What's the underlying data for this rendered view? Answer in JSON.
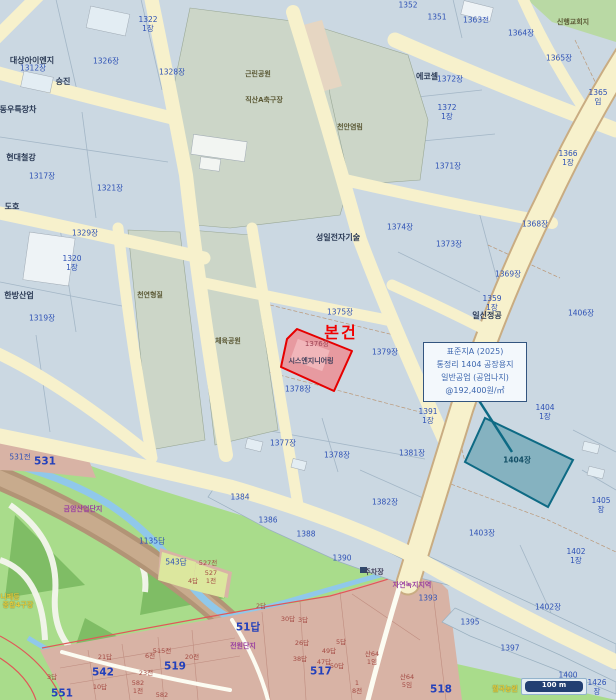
{
  "subject": {
    "marker": "본건",
    "parcel_no": "1376장",
    "company": "시스엔지니어링"
  },
  "annotation": {
    "lines": [
      "표준지A (2025)",
      "통정리 1404 공장용지",
      "일반공업 (공업나지)",
      "@192,400원/㎡"
    ]
  },
  "scale_bar": {
    "text": "100 m"
  },
  "colors": {
    "parcel_fill": "#cbd8e2",
    "road_fill": "#f7f1cc",
    "green_zone": "#a9dc8b",
    "park_gray_green": "#ccd6c8",
    "pink_zone": "#d8b3a5",
    "brown_band": "#b29476",
    "stream": "#90c8ea",
    "subject_fill": "#e79aa0",
    "subject_border": "#e60000",
    "standard_lot_fill": "#85b2c0",
    "standard_lot_border": "#0e6a84",
    "annotation_text": "#3c66ae",
    "scalebar_navy": "#223f72",
    "parcel_text": "#2f52b5"
  },
  "map": {
    "labels": [
      {
        "t": "1322\n1장",
        "x": 148,
        "y": 24,
        "c": ""
      },
      {
        "t": "1351",
        "x": 437,
        "y": 17,
        "c": ""
      },
      {
        "t": "1352",
        "x": 408,
        "y": 5,
        "c": ""
      },
      {
        "t": "1363전",
        "x": 476,
        "y": 20,
        "c": ""
      },
      {
        "t": "1364장",
        "x": 521,
        "y": 33,
        "c": ""
      },
      {
        "t": "1365장",
        "x": 559,
        "y": 58,
        "c": ""
      },
      {
        "t": "1365임",
        "x": 598,
        "y": 97,
        "c": ""
      },
      {
        "t": "1326장",
        "x": 106,
        "y": 61,
        "c": ""
      },
      {
        "t": "1328장",
        "x": 172,
        "y": 72,
        "c": ""
      },
      {
        "t": "1312장",
        "x": 33,
        "y": 68,
        "c": ""
      },
      {
        "t": "1317장",
        "x": 42,
        "y": 176,
        "c": ""
      },
      {
        "t": "1321장",
        "x": 110,
        "y": 188,
        "c": ""
      },
      {
        "t": "1329장",
        "x": 85,
        "y": 233,
        "c": ""
      },
      {
        "t": "1320\n1장",
        "x": 72,
        "y": 263,
        "c": ""
      },
      {
        "t": "1319장",
        "x": 42,
        "y": 318,
        "c": ""
      },
      {
        "t": "1372장",
        "x": 450,
        "y": 79,
        "c": ""
      },
      {
        "t": "1372\n1장",
        "x": 447,
        "y": 112,
        "c": ""
      },
      {
        "t": "1371장",
        "x": 448,
        "y": 166,
        "c": ""
      },
      {
        "t": "1366\n1장",
        "x": 568,
        "y": 158,
        "c": ""
      },
      {
        "t": "1368장",
        "x": 535,
        "y": 224,
        "c": ""
      },
      {
        "t": "1373장",
        "x": 449,
        "y": 244,
        "c": ""
      },
      {
        "t": "1374장",
        "x": 400,
        "y": 227,
        "c": ""
      },
      {
        "t": "1369장",
        "x": 508,
        "y": 274,
        "c": ""
      },
      {
        "t": "1359\n1장",
        "x": 492,
        "y": 303,
        "c": ""
      },
      {
        "t": "1406장",
        "x": 581,
        "y": 313,
        "c": ""
      },
      {
        "t": "1375장",
        "x": 340,
        "y": 312,
        "c": ""
      },
      {
        "t": "1379장",
        "x": 385,
        "y": 352,
        "c": ""
      },
      {
        "t": "1378장",
        "x": 298,
        "y": 389,
        "c": ""
      },
      {
        "t": "1377장",
        "x": 283,
        "y": 443,
        "c": ""
      },
      {
        "t": "1378장",
        "x": 337,
        "y": 455,
        "c": ""
      },
      {
        "t": "1381장",
        "x": 412,
        "y": 453,
        "c": ""
      },
      {
        "t": "1382장",
        "x": 385,
        "y": 502,
        "c": ""
      },
      {
        "t": "1391\n1장",
        "x": 428,
        "y": 416,
        "c": ""
      },
      {
        "t": "1388",
        "x": 306,
        "y": 534,
        "c": ""
      },
      {
        "t": "1384",
        "x": 240,
        "y": 497,
        "c": ""
      },
      {
        "t": "1386",
        "x": 268,
        "y": 520,
        "c": ""
      },
      {
        "t": "1390",
        "x": 342,
        "y": 558,
        "c": ""
      },
      {
        "t": "1393",
        "x": 428,
        "y": 598,
        "c": ""
      },
      {
        "t": "1395",
        "x": 470,
        "y": 622,
        "c": ""
      },
      {
        "t": "1397",
        "x": 510,
        "y": 648,
        "c": ""
      },
      {
        "t": "1400",
        "x": 568,
        "y": 675,
        "c": ""
      },
      {
        "t": "1402장",
        "x": 548,
        "y": 607,
        "c": ""
      },
      {
        "t": "1402\n1장",
        "x": 576,
        "y": 556,
        "c": ""
      },
      {
        "t": "1403장",
        "x": 482,
        "y": 533,
        "c": ""
      },
      {
        "t": "1404\n1장",
        "x": 545,
        "y": 412,
        "c": ""
      },
      {
        "t": "1405장",
        "x": 601,
        "y": 505,
        "c": ""
      },
      {
        "t": "1426장",
        "x": 597,
        "y": 687,
        "c": ""
      },
      {
        "t": "531전",
        "x": 20,
        "y": 457,
        "c": ""
      },
      {
        "t": "1135답",
        "x": 152,
        "y": 541,
        "c": ""
      },
      {
        "t": "543답",
        "x": 176,
        "y": 562,
        "c": ""
      },
      {
        "t": "1376장",
        "x": 317,
        "y": 344,
        "c": "subject-num"
      },
      {
        "t": "1404장",
        "x": 517,
        "y": 460,
        "c": "teal-num"
      },
      {
        "t": "531",
        "x": 45,
        "y": 462,
        "c": "zone-big"
      },
      {
        "t": "51답",
        "x": 248,
        "y": 628,
        "c": "zone-big"
      },
      {
        "t": "517",
        "x": 321,
        "y": 672,
        "c": "zone-big"
      },
      {
        "t": "518",
        "x": 441,
        "y": 690,
        "c": "zone-big"
      },
      {
        "t": "519",
        "x": 175,
        "y": 667,
        "c": "zone-big"
      },
      {
        "t": "542",
        "x": 103,
        "y": 673,
        "c": "zone-big"
      },
      {
        "t": "551",
        "x": 62,
        "y": 694,
        "c": "zone-big"
      },
      {
        "t": "2답",
        "x": 261,
        "y": 607,
        "c": "pink-num"
      },
      {
        "t": "30답",
        "x": 288,
        "y": 620,
        "c": "pink-num"
      },
      {
        "t": "3답",
        "x": 303,
        "y": 621,
        "c": "pink-num"
      },
      {
        "t": "26답",
        "x": 302,
        "y": 644,
        "c": "pink-num"
      },
      {
        "t": "5답",
        "x": 341,
        "y": 643,
        "c": "pink-num"
      },
      {
        "t": "49답",
        "x": 329,
        "y": 652,
        "c": "pink-num"
      },
      {
        "t": "38답",
        "x": 300,
        "y": 660,
        "c": "pink-num"
      },
      {
        "t": "47답",
        "x": 324,
        "y": 663,
        "c": "pink-num"
      },
      {
        "t": "50답",
        "x": 337,
        "y": 667,
        "c": "pink-num"
      },
      {
        "t": "21답",
        "x": 105,
        "y": 658,
        "c": "pink-num"
      },
      {
        "t": "10답",
        "x": 100,
        "y": 688,
        "c": "pink-num"
      },
      {
        "t": "3답",
        "x": 52,
        "y": 678,
        "c": "pink-num"
      },
      {
        "t": "6전",
        "x": 150,
        "y": 657,
        "c": "pink-num"
      },
      {
        "t": "515전",
        "x": 162,
        "y": 652,
        "c": "pink-num"
      },
      {
        "t": "20전",
        "x": 192,
        "y": 658,
        "c": "pink-num"
      },
      {
        "t": "23전",
        "x": 146,
        "y": 674,
        "c": "pink-num"
      },
      {
        "t": "582\n1전",
        "x": 138,
        "y": 688,
        "c": "pink-num"
      },
      {
        "t": "582",
        "x": 162,
        "y": 696,
        "c": "pink-num"
      },
      {
        "t": "산64\n1임",
        "x": 372,
        "y": 659,
        "c": "pink-num"
      },
      {
        "t": "산64\n5임",
        "x": 407,
        "y": 682,
        "c": "pink-num"
      },
      {
        "t": "1\n8전",
        "x": 357,
        "y": 688,
        "c": "pink-num"
      },
      {
        "t": "527전",
        "x": 208,
        "y": 564,
        "c": "pink-num"
      },
      {
        "t": "527\n1전",
        "x": 211,
        "y": 578,
        "c": "pink-num"
      },
      {
        "t": "4답",
        "x": 193,
        "y": 582,
        "c": "pink-num"
      },
      {
        "t": "대상아이엔지",
        "x": 32,
        "y": 61,
        "c": "company"
      },
      {
        "t": "승진",
        "x": 63,
        "y": 82,
        "c": "company"
      },
      {
        "t": "동우특장차",
        "x": 18,
        "y": 110,
        "c": "company"
      },
      {
        "t": "현대철강",
        "x": 21,
        "y": 158,
        "c": "company"
      },
      {
        "t": "도호",
        "x": 12,
        "y": 207,
        "c": "company"
      },
      {
        "t": "한방산업",
        "x": 19,
        "y": 296,
        "c": "company"
      },
      {
        "t": "에코셀",
        "x": 427,
        "y": 77,
        "c": "company"
      },
      {
        "t": "성일전자기술",
        "x": 338,
        "y": 238,
        "c": "company"
      },
      {
        "t": "일신정공",
        "x": 487,
        "y": 316,
        "c": "company"
      },
      {
        "t": "주차장",
        "x": 374,
        "y": 572,
        "c": "company-sm"
      },
      {
        "t": "시스엔지니어링",
        "x": 311,
        "y": 361,
        "c": "company-sm"
      },
      {
        "t": "신행교회지",
        "x": 573,
        "y": 22,
        "c": "green-label"
      },
      {
        "t": "근린공원",
        "x": 258,
        "y": 74,
        "c": "green-label"
      },
      {
        "t": "직산A축구장",
        "x": 264,
        "y": 100,
        "c": "green-label"
      },
      {
        "t": "천안염림",
        "x": 350,
        "y": 127,
        "c": "green-label"
      },
      {
        "t": "천연형질",
        "x": 150,
        "y": 295,
        "c": "green-label"
      },
      {
        "t": "체육공원",
        "x": 228,
        "y": 341,
        "c": "green-label"
      },
      {
        "t": "자연녹지지역",
        "x": 412,
        "y": 585,
        "c": "purple"
      },
      {
        "t": "전원단지",
        "x": 243,
        "y": 646,
        "c": "purple"
      },
      {
        "t": "금암산업단지",
        "x": 83,
        "y": 509,
        "c": "purple"
      },
      {
        "t": "니페등",
        "x": 10,
        "y": 597,
        "c": "yellow"
      },
      {
        "t": "종합4구장",
        "x": 18,
        "y": 605,
        "c": "yellow"
      },
      {
        "t": "월곡농원",
        "x": 505,
        "y": 689,
        "c": "yellow"
      }
    ]
  }
}
